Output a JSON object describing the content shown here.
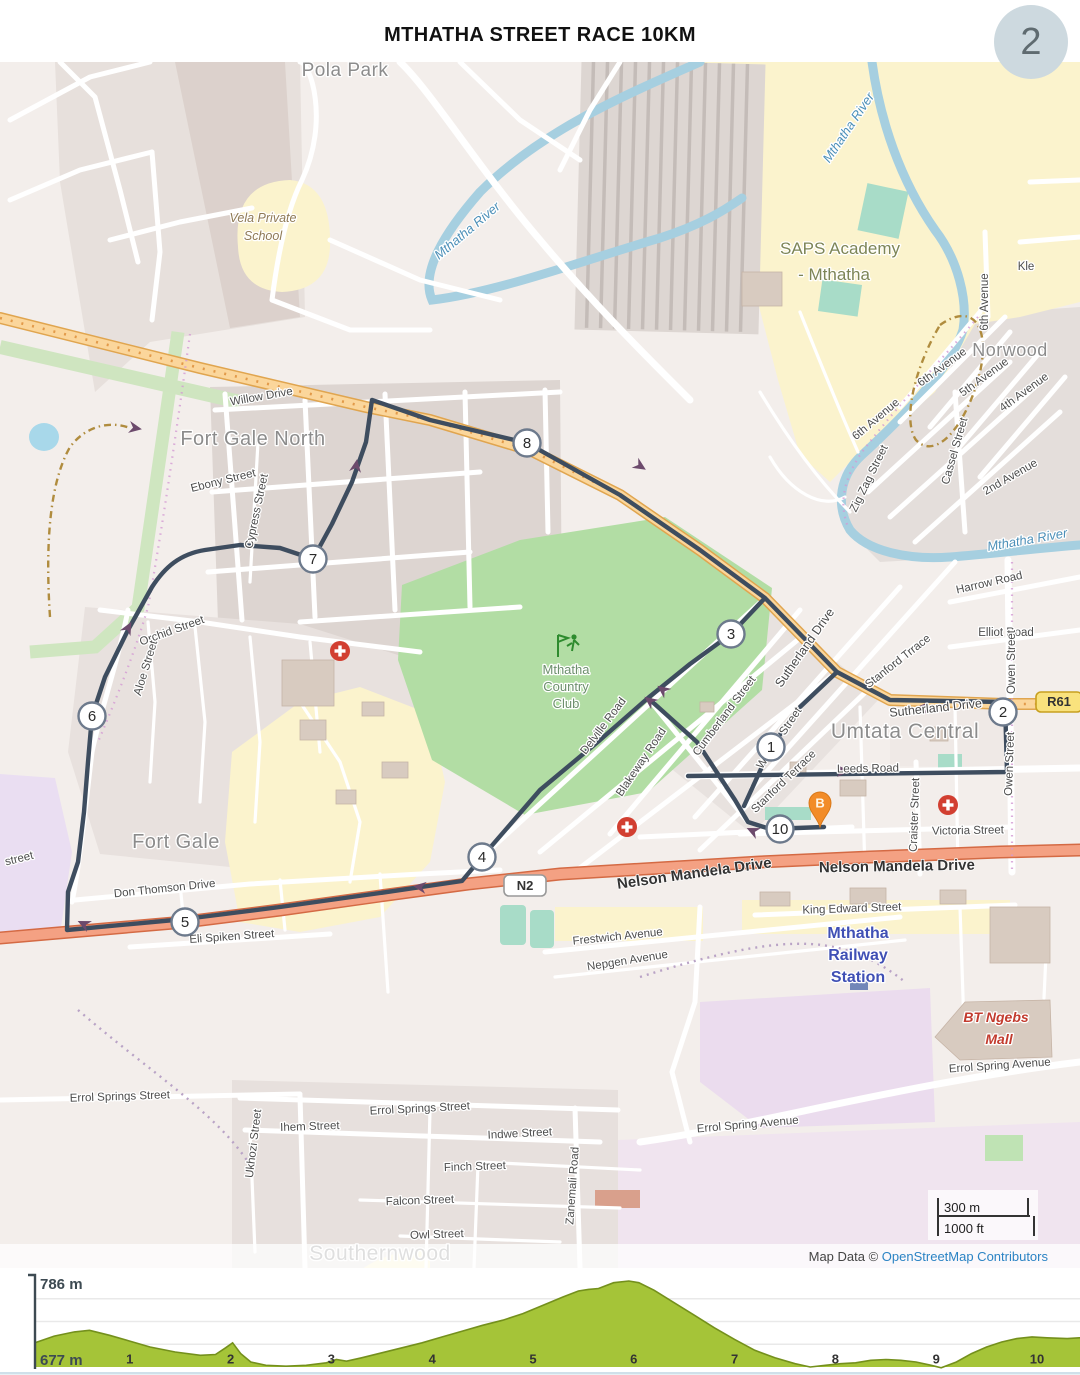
{
  "page": {
    "title": "MTHATHA STREET RACE 10KM",
    "page_number": "2"
  },
  "map": {
    "attribution": {
      "prefix": "Map Data © ",
      "link": "OpenStreetMap Contributors"
    },
    "scale_bar": {
      "metric": "300 m",
      "imperial": "1000 ft"
    },
    "route_color": "#3e4d5f",
    "start_pin": {
      "label": "B",
      "x": 820,
      "y": 741,
      "color": "#f28c28"
    },
    "shields": [
      {
        "label": "N2",
        "x": 504,
        "y": 813,
        "w": 42,
        "h": 21,
        "fill": "#ffffff",
        "border": "#999999"
      },
      {
        "label": "R61",
        "x": 1036,
        "y": 630,
        "w": 46,
        "h": 20,
        "fill": "#f9e27d",
        "border": "#c8a020"
      }
    ],
    "km_markers": [
      {
        "n": "1",
        "x": 771,
        "y": 685
      },
      {
        "n": "2",
        "x": 1003,
        "y": 650
      },
      {
        "n": "3",
        "x": 731,
        "y": 572
      },
      {
        "n": "4",
        "x": 482,
        "y": 795
      },
      {
        "n": "5",
        "x": 185,
        "y": 860
      },
      {
        "n": "6",
        "x": 92,
        "y": 654
      },
      {
        "n": "7",
        "x": 313,
        "y": 497
      },
      {
        "n": "8",
        "x": 527,
        "y": 381
      },
      {
        "n": "10",
        "x": 780,
        "y": 767
      }
    ],
    "arrows": [
      {
        "x": 843,
        "y": 709,
        "r": 0
      },
      {
        "x": 922,
        "y": 646,
        "r": 182
      },
      {
        "x": 663,
        "y": 628,
        "r": 217
      },
      {
        "x": 650,
        "y": 639,
        "r": 217
      },
      {
        "x": 420,
        "y": 825,
        "r": 188
      },
      {
        "x": 84,
        "y": 862,
        "r": 205
      },
      {
        "x": 128,
        "y": 566,
        "r": 298
      },
      {
        "x": 356,
        "y": 404,
        "r": 279
      },
      {
        "x": 640,
        "y": 404,
        "r": 33
      },
      {
        "x": 753,
        "y": 769,
        "r": 205
      },
      {
        "x": 135,
        "y": 366,
        "r": 10
      }
    ],
    "hospitals": [
      {
        "x": 340,
        "y": 589
      },
      {
        "x": 627,
        "y": 765
      },
      {
        "x": 948,
        "y": 743
      }
    ],
    "golf_club_icon": {
      "x": 566,
      "y": 585,
      "color": "#2e8b2e"
    },
    "labels": [
      {
        "t": "Pola Park",
        "x": 345,
        "y": 14,
        "r": 0,
        "c": "pl",
        "s": 19
      },
      {
        "t": "Vela Private",
        "x": 263,
        "y": 160,
        "r": 0,
        "c": "sc"
      },
      {
        "t": "School",
        "x": 263,
        "y": 178,
        "r": 0,
        "c": "sc"
      },
      {
        "t": "Mthatha River",
        "x": 470,
        "y": 172,
        "r": -40,
        "c": "wa"
      },
      {
        "t": "Mthatha River",
        "x": 852,
        "y": 68,
        "r": -56,
        "c": "wa"
      },
      {
        "t": "Mthatha River",
        "x": 1028,
        "y": 482,
        "r": -10,
        "c": "wa"
      },
      {
        "t": "SAPS Academy",
        "x": 840,
        "y": 192,
        "r": 0,
        "c": "ac"
      },
      {
        "t": "- Mthatha",
        "x": 834,
        "y": 218,
        "r": 0,
        "c": "ac"
      },
      {
        "t": "Kle",
        "x": 1026,
        "y": 208,
        "r": 0,
        "c": "st"
      },
      {
        "t": "Norwood",
        "x": 1010,
        "y": 294,
        "r": 0,
        "c": "pl",
        "s": 18
      },
      {
        "t": "6th Avenue",
        "x": 988,
        "y": 240,
        "r": -90,
        "c": "st"
      },
      {
        "t": "6th Avenue",
        "x": 944,
        "y": 308,
        "r": -36,
        "c": "st"
      },
      {
        "t": "5th Avenue",
        "x": 986,
        "y": 318,
        "r": -36,
        "c": "st"
      },
      {
        "t": "4th Avenue",
        "x": 1026,
        "y": 333,
        "r": -36,
        "c": "st"
      },
      {
        "t": "6th Avenue",
        "x": 878,
        "y": 360,
        "r": -40,
        "c": "st"
      },
      {
        "t": "2nd Avenue",
        "x": 1012,
        "y": 418,
        "r": -30,
        "c": "st"
      },
      {
        "t": "Cassel Street",
        "x": 958,
        "y": 390,
        "r": -74,
        "c": "st"
      },
      {
        "t": "Zig Zag Street",
        "x": 872,
        "y": 418,
        "r": -64,
        "c": "st"
      },
      {
        "t": "Harrow Road",
        "x": 990,
        "y": 524,
        "r": -13,
        "c": "st"
      },
      {
        "t": "Elliot Road",
        "x": 1006,
        "y": 574,
        "r": 0,
        "c": "st"
      },
      {
        "t": "Owen Street",
        "x": 1015,
        "y": 600,
        "r": -90,
        "c": "st"
      },
      {
        "t": "Owen Street",
        "x": 1013,
        "y": 702,
        "r": -88,
        "c": "st"
      },
      {
        "t": "Willow Drive",
        "x": 262,
        "y": 338,
        "r": -10,
        "c": "st"
      },
      {
        "t": "Fort Gale North",
        "x": 253,
        "y": 383,
        "r": 0,
        "c": "pl",
        "s": 20
      },
      {
        "t": "Ebony Street",
        "x": 224,
        "y": 422,
        "r": -14,
        "c": "st"
      },
      {
        "t": "Cypress Street",
        "x": 260,
        "y": 450,
        "r": -78,
        "c": "st"
      },
      {
        "t": "Orchid Street",
        "x": 173,
        "y": 572,
        "r": -20,
        "c": "st"
      },
      {
        "t": "Aloe Street",
        "x": 149,
        "y": 607,
        "r": -73,
        "c": "st"
      },
      {
        "t": "Fort Gale",
        "x": 176,
        "y": 786,
        "r": 0,
        "c": "pl",
        "s": 20
      },
      {
        "t": "Don Thomson Drive",
        "x": 165,
        "y": 830,
        "r": -6,
        "c": "st"
      },
      {
        "t": "Eli Spiken Street",
        "x": 232,
        "y": 878,
        "r": -4,
        "c": "st"
      },
      {
        "t": "street",
        "x": 20,
        "y": 800,
        "r": -14,
        "c": "st"
      },
      {
        "t": "Sutherland Drive",
        "x": 808,
        "y": 588,
        "r": -55,
        "c": "rd"
      },
      {
        "t": "Sutherland Drive",
        "x": 936,
        "y": 650,
        "r": -6,
        "c": "rd"
      },
      {
        "t": "Stanford Trrace",
        "x": 900,
        "y": 602,
        "r": -38,
        "c": "st"
      },
      {
        "t": "Stanford Terrace",
        "x": 786,
        "y": 722,
        "r": -44,
        "c": "st"
      },
      {
        "t": "Cumberland Street",
        "x": 727,
        "y": 656,
        "r": -53,
        "c": "st"
      },
      {
        "t": "Wesley Street",
        "x": 782,
        "y": 678,
        "r": -56,
        "c": "st"
      },
      {
        "t": "Blakeway Road",
        "x": 644,
        "y": 702,
        "r": -56,
        "c": "st"
      },
      {
        "t": "Delville Road",
        "x": 606,
        "y": 666,
        "r": -53,
        "c": "st"
      },
      {
        "t": "Leeds Road",
        "x": 868,
        "y": 710,
        "r": -1,
        "c": "st"
      },
      {
        "t": "Craister Street",
        "x": 918,
        "y": 753,
        "r": -88,
        "c": "st"
      },
      {
        "t": "Victoria Street",
        "x": 968,
        "y": 772,
        "r": -1,
        "c": "st"
      },
      {
        "t": "Umtata Central",
        "x": 905,
        "y": 676,
        "r": 0,
        "c": "pl",
        "s": 21
      },
      {
        "t": "Mthatha",
        "x": 566,
        "y": 612,
        "r": 0,
        "c": "cl"
      },
      {
        "t": "Country",
        "x": 566,
        "y": 629,
        "r": 0,
        "c": "cl"
      },
      {
        "t": "Club",
        "x": 566,
        "y": 646,
        "r": 0,
        "c": "cl"
      },
      {
        "t": "Nelson Mandela Drive",
        "x": 695,
        "y": 816,
        "r": -8,
        "c": "nm"
      },
      {
        "t": "Nelson Mandela Drive",
        "x": 897,
        "y": 809,
        "r": -1,
        "c": "nm"
      },
      {
        "t": "King Edward Street",
        "x": 852,
        "y": 850,
        "r": -2,
        "c": "st"
      },
      {
        "t": "Mthatha",
        "x": 858,
        "y": 876,
        "r": 0,
        "c": "sn"
      },
      {
        "t": "Railway",
        "x": 858,
        "y": 898,
        "r": 0,
        "c": "sn"
      },
      {
        "t": "Station",
        "x": 858,
        "y": 920,
        "r": 0,
        "c": "sn"
      },
      {
        "t": "BT Ngebs",
        "x": 996,
        "y": 960,
        "r": 0,
        "c": "ml"
      },
      {
        "t": "Mall",
        "x": 999,
        "y": 982,
        "r": 0,
        "c": "ml"
      },
      {
        "t": "Errol Spring Avenue",
        "x": 1000,
        "y": 1007,
        "r": -4,
        "c": "st"
      },
      {
        "t": "Errol Spring Avenue",
        "x": 748,
        "y": 1066,
        "r": -5,
        "c": "st"
      },
      {
        "t": "Errol Springs Street",
        "x": 120,
        "y": 1038,
        "r": -2,
        "c": "st"
      },
      {
        "t": "Errol Springs Street",
        "x": 420,
        "y": 1050,
        "r": -3,
        "c": "st"
      },
      {
        "t": "Ihem Street",
        "x": 310,
        "y": 1068,
        "r": -2,
        "c": "st"
      },
      {
        "t": "Indwe Street",
        "x": 520,
        "y": 1075,
        "r": -3,
        "c": "st"
      },
      {
        "t": "Finch Street",
        "x": 475,
        "y": 1108,
        "r": -2,
        "c": "st"
      },
      {
        "t": "Falcon Street",
        "x": 420,
        "y": 1142,
        "r": -2,
        "c": "st"
      },
      {
        "t": "Owl Street",
        "x": 437,
        "y": 1176,
        "r": -2,
        "c": "st"
      },
      {
        "t": "Ukhozi Street",
        "x": 257,
        "y": 1082,
        "r": -83,
        "c": "st"
      },
      {
        "t": "Zanemali Road",
        "x": 576,
        "y": 1124,
        "r": -86,
        "c": "st"
      },
      {
        "t": "Southernwood",
        "x": 380,
        "y": 1198,
        "r": 0,
        "c": "pl",
        "s": 21
      },
      {
        "t": "Frestwich Avenue",
        "x": 618,
        "y": 878,
        "r": -6,
        "c": "st"
      },
      {
        "t": "Nepgen Avenue",
        "x": 628,
        "y": 902,
        "r": -9,
        "c": "st"
      }
    ]
  },
  "chart_data": {
    "type": "area",
    "title": "Race elevation profile",
    "ylabel_top": "786 m",
    "ylabel_bottom": "677 m",
    "ymin": 677,
    "ymax": 786,
    "x_ticks": [
      1,
      2,
      3,
      4,
      5,
      6,
      7,
      8,
      9,
      10
    ],
    "xlabel": "distance (km)",
    "fill": "#a5c438",
    "line": "#74901c",
    "points": [
      [
        0.06,
        706
      ],
      [
        0.25,
        714
      ],
      [
        0.45,
        719
      ],
      [
        0.6,
        721
      ],
      [
        0.8,
        715
      ],
      [
        1.0,
        708
      ],
      [
        1.2,
        701
      ],
      [
        1.45,
        695
      ],
      [
        1.7,
        691
      ],
      [
        1.85,
        692
      ],
      [
        1.95,
        700
      ],
      [
        2.02,
        706
      ],
      [
        2.1,
        693
      ],
      [
        2.2,
        683
      ],
      [
        2.35,
        679
      ],
      [
        2.55,
        678
      ],
      [
        2.75,
        679
      ],
      [
        2.95,
        682
      ],
      [
        3.05,
        686
      ],
      [
        3.15,
        684
      ],
      [
        3.3,
        688
      ],
      [
        3.5,
        694
      ],
      [
        3.7,
        700
      ],
      [
        3.9,
        706
      ],
      [
        4.1,
        713
      ],
      [
        4.3,
        720
      ],
      [
        4.5,
        727
      ],
      [
        4.7,
        733
      ],
      [
        4.9,
        741
      ],
      [
        5.1,
        751
      ],
      [
        5.3,
        761
      ],
      [
        5.45,
        768
      ],
      [
        5.55,
        770
      ],
      [
        5.65,
        771
      ],
      [
        5.8,
        778
      ],
      [
        5.95,
        780
      ],
      [
        6.05,
        778
      ],
      [
        6.2,
        769
      ],
      [
        6.4,
        754
      ],
      [
        6.6,
        739
      ],
      [
        6.8,
        724
      ],
      [
        7.0,
        710
      ],
      [
        7.2,
        697
      ],
      [
        7.4,
        688
      ],
      [
        7.6,
        681
      ],
      [
        7.75,
        677
      ],
      [
        7.9,
        679
      ],
      [
        8.05,
        681
      ],
      [
        8.2,
        682
      ],
      [
        8.35,
        685
      ],
      [
        8.5,
        686
      ],
      [
        8.65,
        685
      ],
      [
        8.8,
        683
      ],
      [
        8.95,
        679
      ],
      [
        9.05,
        676
      ],
      [
        9.2,
        683
      ],
      [
        9.35,
        693
      ],
      [
        9.5,
        701
      ],
      [
        9.65,
        707
      ],
      [
        9.8,
        711
      ],
      [
        9.95,
        713
      ],
      [
        10.1,
        712
      ],
      [
        10.3,
        711
      ],
      [
        10.42,
        712
      ]
    ]
  }
}
